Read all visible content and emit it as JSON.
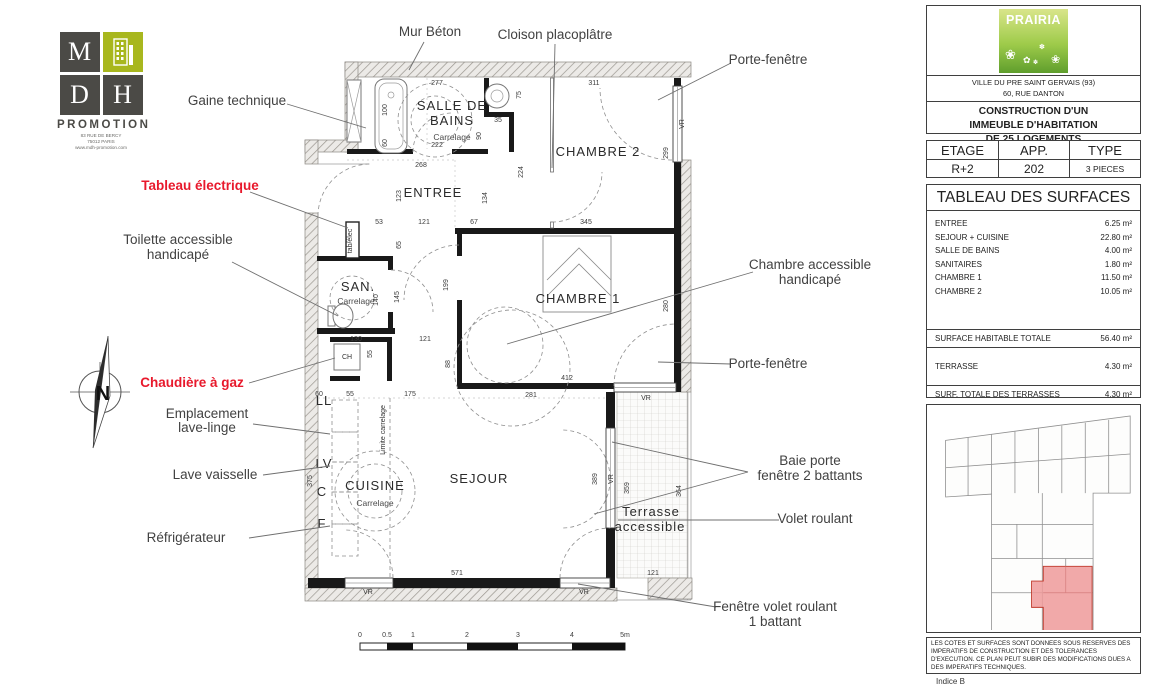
{
  "branding": {
    "mdh": {
      "m": "M",
      "d": "D",
      "h": "H",
      "promotion": "PROMOTION",
      "address1": "83 RUE DE BERCY",
      "address2": "75012 PARIS",
      "website": "www.mdh-promotion.com"
    },
    "compass_n": "N"
  },
  "colors": {
    "accent_red": "#e8192c",
    "logo_green": "#a8b71e",
    "highlight_unit": "#ef9a9a"
  },
  "callouts": {
    "mur_beton": "Mur Béton",
    "cloison": "Cloison placoplâtre",
    "gaine": "Gaine technique",
    "tableau_electrique": "Tableau électrique",
    "toilette_1": "Toilette accessible",
    "toilette_2": "handicapé",
    "chaudiere": "Chaudière à gaz",
    "lave_linge_1": "Emplacement",
    "lave_linge_2": "lave-linge",
    "lave_vaisselle": "Lave vaisselle",
    "refrigerateur": "Réfrigérateur",
    "porte_fenetre_haut": "Porte-fenêtre",
    "chambre_access_1": "Chambre accessible",
    "chambre_access_2": "handicapé",
    "porte_fenetre_milieu": "Porte-fenêtre",
    "baie_1": "Baie porte",
    "baie_2": "fenêtre 2 battants",
    "volet_roulant": "Volet roulant",
    "fenetre_volet_1": "Fenêtre volet roulant",
    "fenetre_volet_2": "1 battant"
  },
  "plan": {
    "rooms": {
      "sdb_1": "SALLE DE",
      "sdb_2": "BAINS",
      "sdb_carrelage": "Carrelage",
      "entree": "ENTREE",
      "san": "SAN.",
      "san_carrelage": "Carrelage",
      "chambre2": "CHAMBRE 2",
      "chambre1": "CHAMBRE 1",
      "cuisine": "CUISINE",
      "cuisine_carrelage": "Carrelage",
      "sejour": "SEJOUR",
      "terrasse_1": "Terrasse",
      "terrasse_2": "accessible",
      "limite_carrelage": "Limite carrelage",
      "tab_elec": "tab/élec",
      "ch": "CH",
      "ll": "LL",
      "lv": "LV",
      "c": "C",
      "f": "F",
      "vr": "VR"
    },
    "dims": {
      "d277": "277",
      "d311": "311",
      "d100": "100",
      "d60a": "60",
      "d222": "222",
      "d268": "268",
      "d75": "75",
      "d35": "35",
      "d90": "90",
      "d224": "224",
      "d134": "134",
      "d123": "123",
      "d299": "299",
      "d345": "345",
      "d53": "53",
      "d121a": "121",
      "d67": "67",
      "d65": "65",
      "d140": "140",
      "d145": "145",
      "d130": "130",
      "d121b": "121",
      "d199": "199",
      "d280": "280",
      "d412": "412",
      "d88": "88",
      "d281": "281",
      "d60b": "60",
      "d55a": "55",
      "d175": "175",
      "d375": "375",
      "d55b": "55",
      "d389": "389",
      "d359": "359",
      "d364": "364",
      "d571": "571",
      "d121c": "121"
    },
    "scale": {
      "l0": "0",
      "l05": "0.5",
      "l1": "1",
      "l2": "2",
      "l3": "3",
      "l4": "4",
      "l5": "5m"
    }
  },
  "panel": {
    "logo": "PRAIRIA",
    "address_1": "VILLE DU PRE SAINT GERVAIS (93)",
    "address_2": "60, RUE DANTON",
    "project_1": "CONSTRUCTION D'UN",
    "project_2": "IMMEUBLE D'HABITATION",
    "project_3": "DE 25 LOGEMENTS",
    "info": {
      "etage_label": "ETAGE",
      "app_label": "APP.",
      "type_label": "TYPE",
      "etage": "R+2",
      "app": "202",
      "type": "3 PIECES"
    },
    "surfaces": {
      "title": "TABLEAU DES SURFACES",
      "rows": [
        {
          "label": "ENTREE",
          "value": "6.25 m²"
        },
        {
          "label": "SEJOUR + CUISINE",
          "value": "22.80 m²"
        },
        {
          "label": "SALLE DE BAINS",
          "value": "4.00 m²"
        },
        {
          "label": "SANITAIRES",
          "value": "1.80 m²"
        },
        {
          "label": "CHAMBRE 1",
          "value": "11.50 m²"
        },
        {
          "label": "CHAMBRE 2",
          "value": "10.05 m²"
        }
      ],
      "total_label": "SURFACE HABITABLE TOTALE",
      "total_value": "56.40 m²",
      "terrasse_label": "TERRASSE",
      "terrasse_value": "4.30 m²",
      "terrasses_total_label": "SURF. TOTALE DES TERRASSES",
      "terrasses_total_value": "4.30 m²"
    },
    "disclaimer": "LES COTES ET SURFACES SONT DONNEES SOUS RESERVES DES IMPERATIFS DE CONSTRUCTION ET DES TOLERANCES D'EXECUTION. CE PLAN PEUT SUBIR DES MODIFICATIONS DUES A DES IMPERATIFS TECHNIQUES.",
    "indice": "Indice B"
  }
}
